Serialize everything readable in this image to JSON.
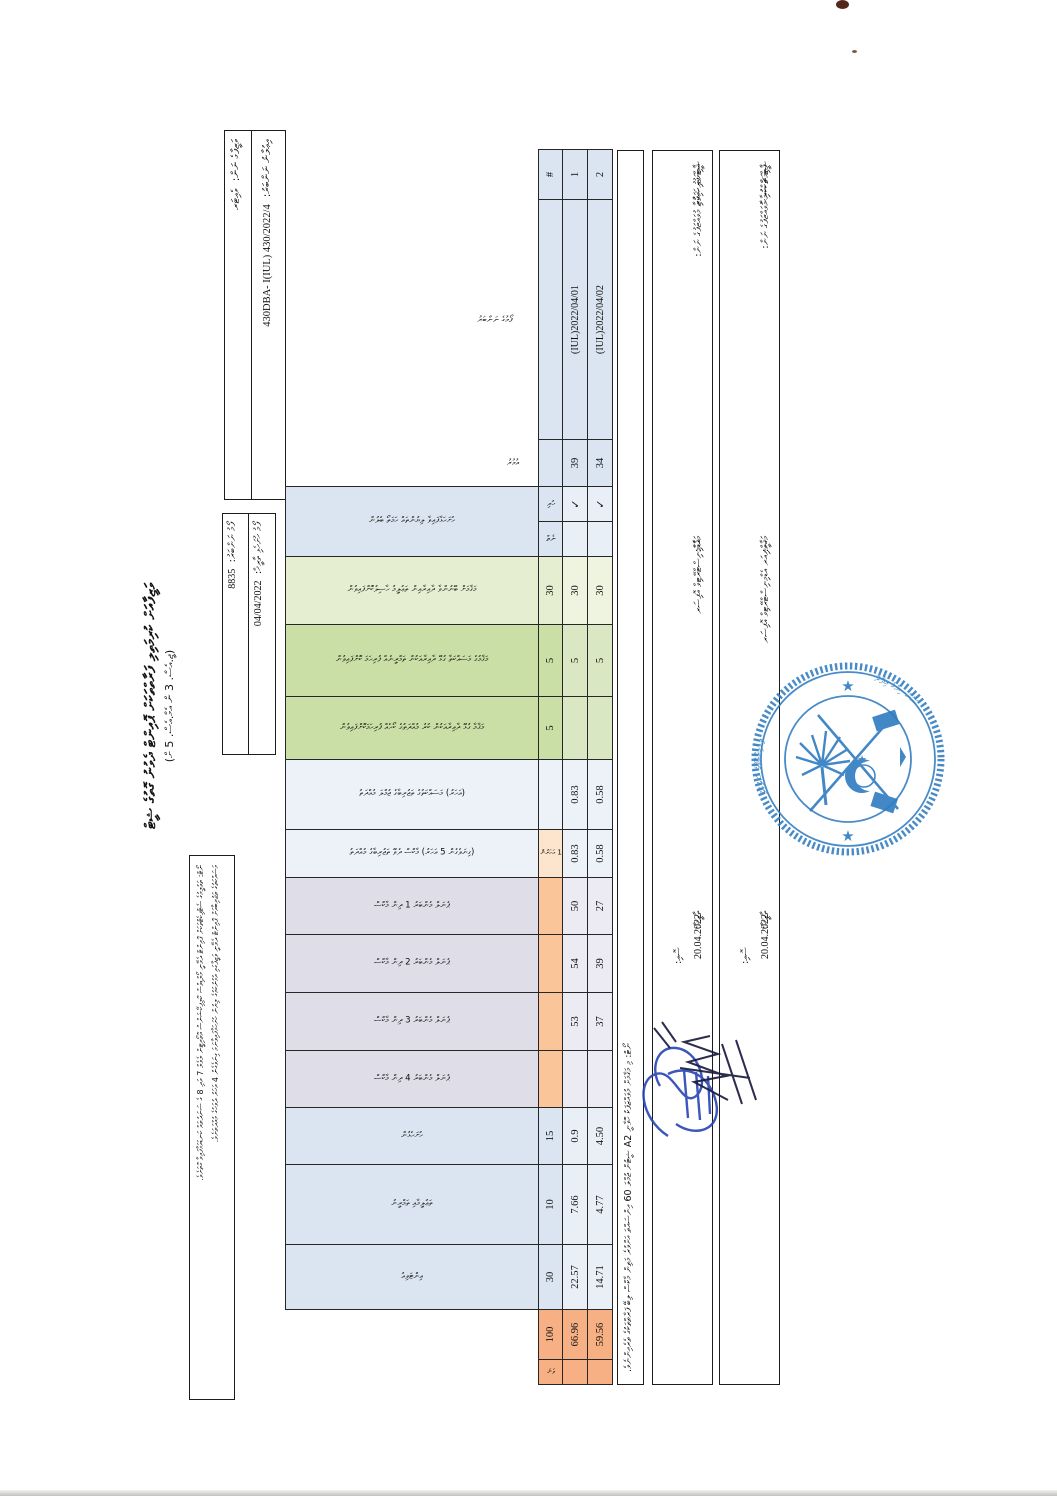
{
  "document": {
    "title_line1": "ވަޒީފާއަށް ކުރިމަތިލި ފަރާތްތަކަށް ޕޮއިންޓް ދެވުނު ގޮތުގެ ޝީޓް",
    "title_line2": "(ޖީ.އެސް. 3 ން އެމް.އެސް. 5 ށް)",
    "info_box1": {
      "row1_label": "ވަޒީފާގެ ނަން:",
      "row1_value": "ވެއިޓަރ",
      "row2_label": "އިޢުލާނު ނަންބަރު:",
      "row2_value": "430DBA- I(IUL) 430/2022/4"
    },
    "info_box2": {
      "row1_label": "ފޯމު ނަންބަރު:",
      "row1_value": "8835",
      "row2_label": "ފޯމު ހުށަހެޅި ތާރީޚް:",
      "row2_value": "04/04/2022"
    },
    "legend_line1": "ނޯޓް: ތަޢުލީމުގެ ސެޓްފިކެޓްތަކަށް ޕޮއިންޓް ދެވޭނީ މޯލްޑިވްސް ކޮލިފިކޭޝަންސް އޮތޯރިޓީން ލެވެލް 7 އަދި 8 ގެ ސަނަދުތައް ކަނޑައަޅާފައިވާ ގޮތަށެވެ.",
    "legend_line2": "މަސައްކަތުގެ ތަޖުރިބާއަށް ޕޮއިންޓް ދެވޭނީ ވަޒީފާގައި އުޅުނުކަމުގެ ލިޔުން ހުށަހަޅާފައިވާނަމަ ގިނަވެގެން 4 އަހަރު ދުވަހުގެ މުއްދަތަށެވެ.",
    "note": "ނޯޓް: މި މަޤާމަށް މުވައްޒަފަކު ހޮވާނީ A2 ޝީޓުން ޖުމްލަ 60 އިންސައްތަ އަށްވުރެ މަތިން މާކްސް ލިބޭ ފަރާތްތަކުގެ ތެރެއިންނެވެ.",
    "stamp": "blue-circular-government-seal",
    "corner_marks": "brown-ink-specks"
  },
  "signatures": [
    {
      "role_label": "ޝީޓް ފުރިހަމަކުރި މުވައްޒަފުގެ ނަން:",
      "name": "އާމިނަތު ޝިފާޒާ",
      "post_label": "މަޤާމް:",
      "post": "އެޑްމިނިސްޓްރޭޓިވް އޮފިސަރ",
      "date_label": "ތާރީޚް:",
      "date": "20.04.2022",
      "sign_label": "ސޮއި:"
    },
    {
      "role_label": "ޝީޓް ޗެކްކުރި މުވައްޒަފުގެ ނަން:",
      "name": "ފާޠިމަތު ސަމާޙާ",
      "post_label": "މަޤާމް:",
      "post": "ސީނިއަރ އެޑްމިނިސްޓްރޭޓިވް އޮފިސަރ",
      "date_label": "ތާރީޚް:",
      "date": "20.04.2022",
      "sign_label": "ސޮއި:"
    }
  ],
  "table": {
    "row_numbers": [
      "1",
      "2"
    ],
    "columns": [
      {
        "id": "hash",
        "header": "",
        "label": "#",
        "labelKind": "num",
        "r1": "1",
        "r2": "2"
      },
      {
        "id": "form",
        "header": "ފޯމުގެ ނަންބަރު",
        "label": "",
        "labelKind": "float",
        "r1": "(IUL)2022/04/01",
        "r2": "(IUL)2022/04/02"
      },
      {
        "id": "age",
        "header": "އުމުރު",
        "label": "",
        "labelKind": "float",
        "r1": "39",
        "r2": "34"
      },
      {
        "id": "docs",
        "header": "ހުށަހަޅާފައިވާ ލިޔުންތައް ހަމަތޯ ބެލުން",
        "labelKind": "group",
        "subs": [
          {
            "label": "ހުރި",
            "r1": "✓",
            "r2": "✓"
          },
          {
            "label": "ނެތް",
            "r1": "",
            "r2": ""
          }
        ]
      },
      {
        "id": "edu",
        "header": "މަޤާމަށް ބޭނުންވާ ދާއިރާއިން ތަޢުލީމު ހާސިލުކޮށްފައިވުން",
        "label": "30",
        "labelKind": "num",
        "r1": "30",
        "r2": "30"
      },
      {
        "id": "train",
        "header": "މަޤާމުގެ މަސައްކަތާ ގުޅޭ ދާއިރާއަކުން ތަމްރީނެއް ފުރިހަމަ ކޮށްފައިވުން",
        "label": "5",
        "labelKind": "num",
        "r1": "5",
        "r2": "5"
      },
      {
        "id": "course",
        "header": "މަޤާމާ ގުޅޭ ދާއިރާއަކުން ކުރު މުއްދަތުގެ ކޯހެއް ފުރިހަމަކޮށްފައިވުން",
        "label": "5",
        "labelKind": "num",
        "r1": "",
        "r2": ""
      },
      {
        "id": "expTot",
        "header": "(އަހަރު) މަސައްކަތުގެ ތަޖުރިބާގެ ޖުމްލަ މުއްދަތު",
        "label": "",
        "labelKind": "num",
        "r1": "0.83",
        "r2": "0.58"
      },
      {
        "id": "expCnt",
        "header": "(ގިނަވެގެން 5 އަހަރު) މާކްސް ދެވޭ ތަޖުރިބާގެ މުއްދަތު",
        "label": "1 އަހަރުން",
        "labelKind": "vsmall",
        "r1": "0.83",
        "r2": "0.58"
      },
      {
        "id": "p1",
        "header": "ޕެނަލް މެންބަރު 1 ދިން މާކްސް",
        "label": "",
        "labelKind": "num",
        "r1": "50",
        "r2": "27"
      },
      {
        "id": "p2",
        "header": "ޕެނަލް މެންބަރު 2 ދިން މާކްސް",
        "label": "",
        "labelKind": "num",
        "r1": "54",
        "r2": "39"
      },
      {
        "id": "p3",
        "header": "ޕެނަލް މެންބަރު 3 ދިން މާކްސް",
        "label": "",
        "labelKind": "num",
        "r1": "53",
        "r2": "37"
      },
      {
        "id": "p4",
        "header": "ޕެނަލް މެންބަރު 4 ދިން މާކްސް",
        "label": "",
        "labelKind": "num",
        "r1": "",
        "r2": ""
      },
      {
        "id": "c15",
        "header": "ހުށަހެޅުން",
        "label": "15",
        "labelKind": "num",
        "r1": "0.9",
        "r2": "4.50"
      },
      {
        "id": "c10",
        "header": "ތަޢުލީމާއި ތަމްރީނު",
        "label": "10",
        "labelKind": "num",
        "r1": "7.66",
        "r2": "4.77"
      },
      {
        "id": "c30",
        "header": "އިންޓަވިއު",
        "label": "30",
        "labelKind": "num",
        "r1": "22.57",
        "r2": "14.71"
      },
      {
        "id": "c100",
        "header": "",
        "label": "100",
        "labelKind": "num",
        "r1": "66.96",
        "r2": "59.56"
      },
      {
        "id": "rank",
        "header": "",
        "label": "ވަނަ",
        "labelKind": "vsmall",
        "r1": "",
        "r2": ""
      }
    ]
  }
}
